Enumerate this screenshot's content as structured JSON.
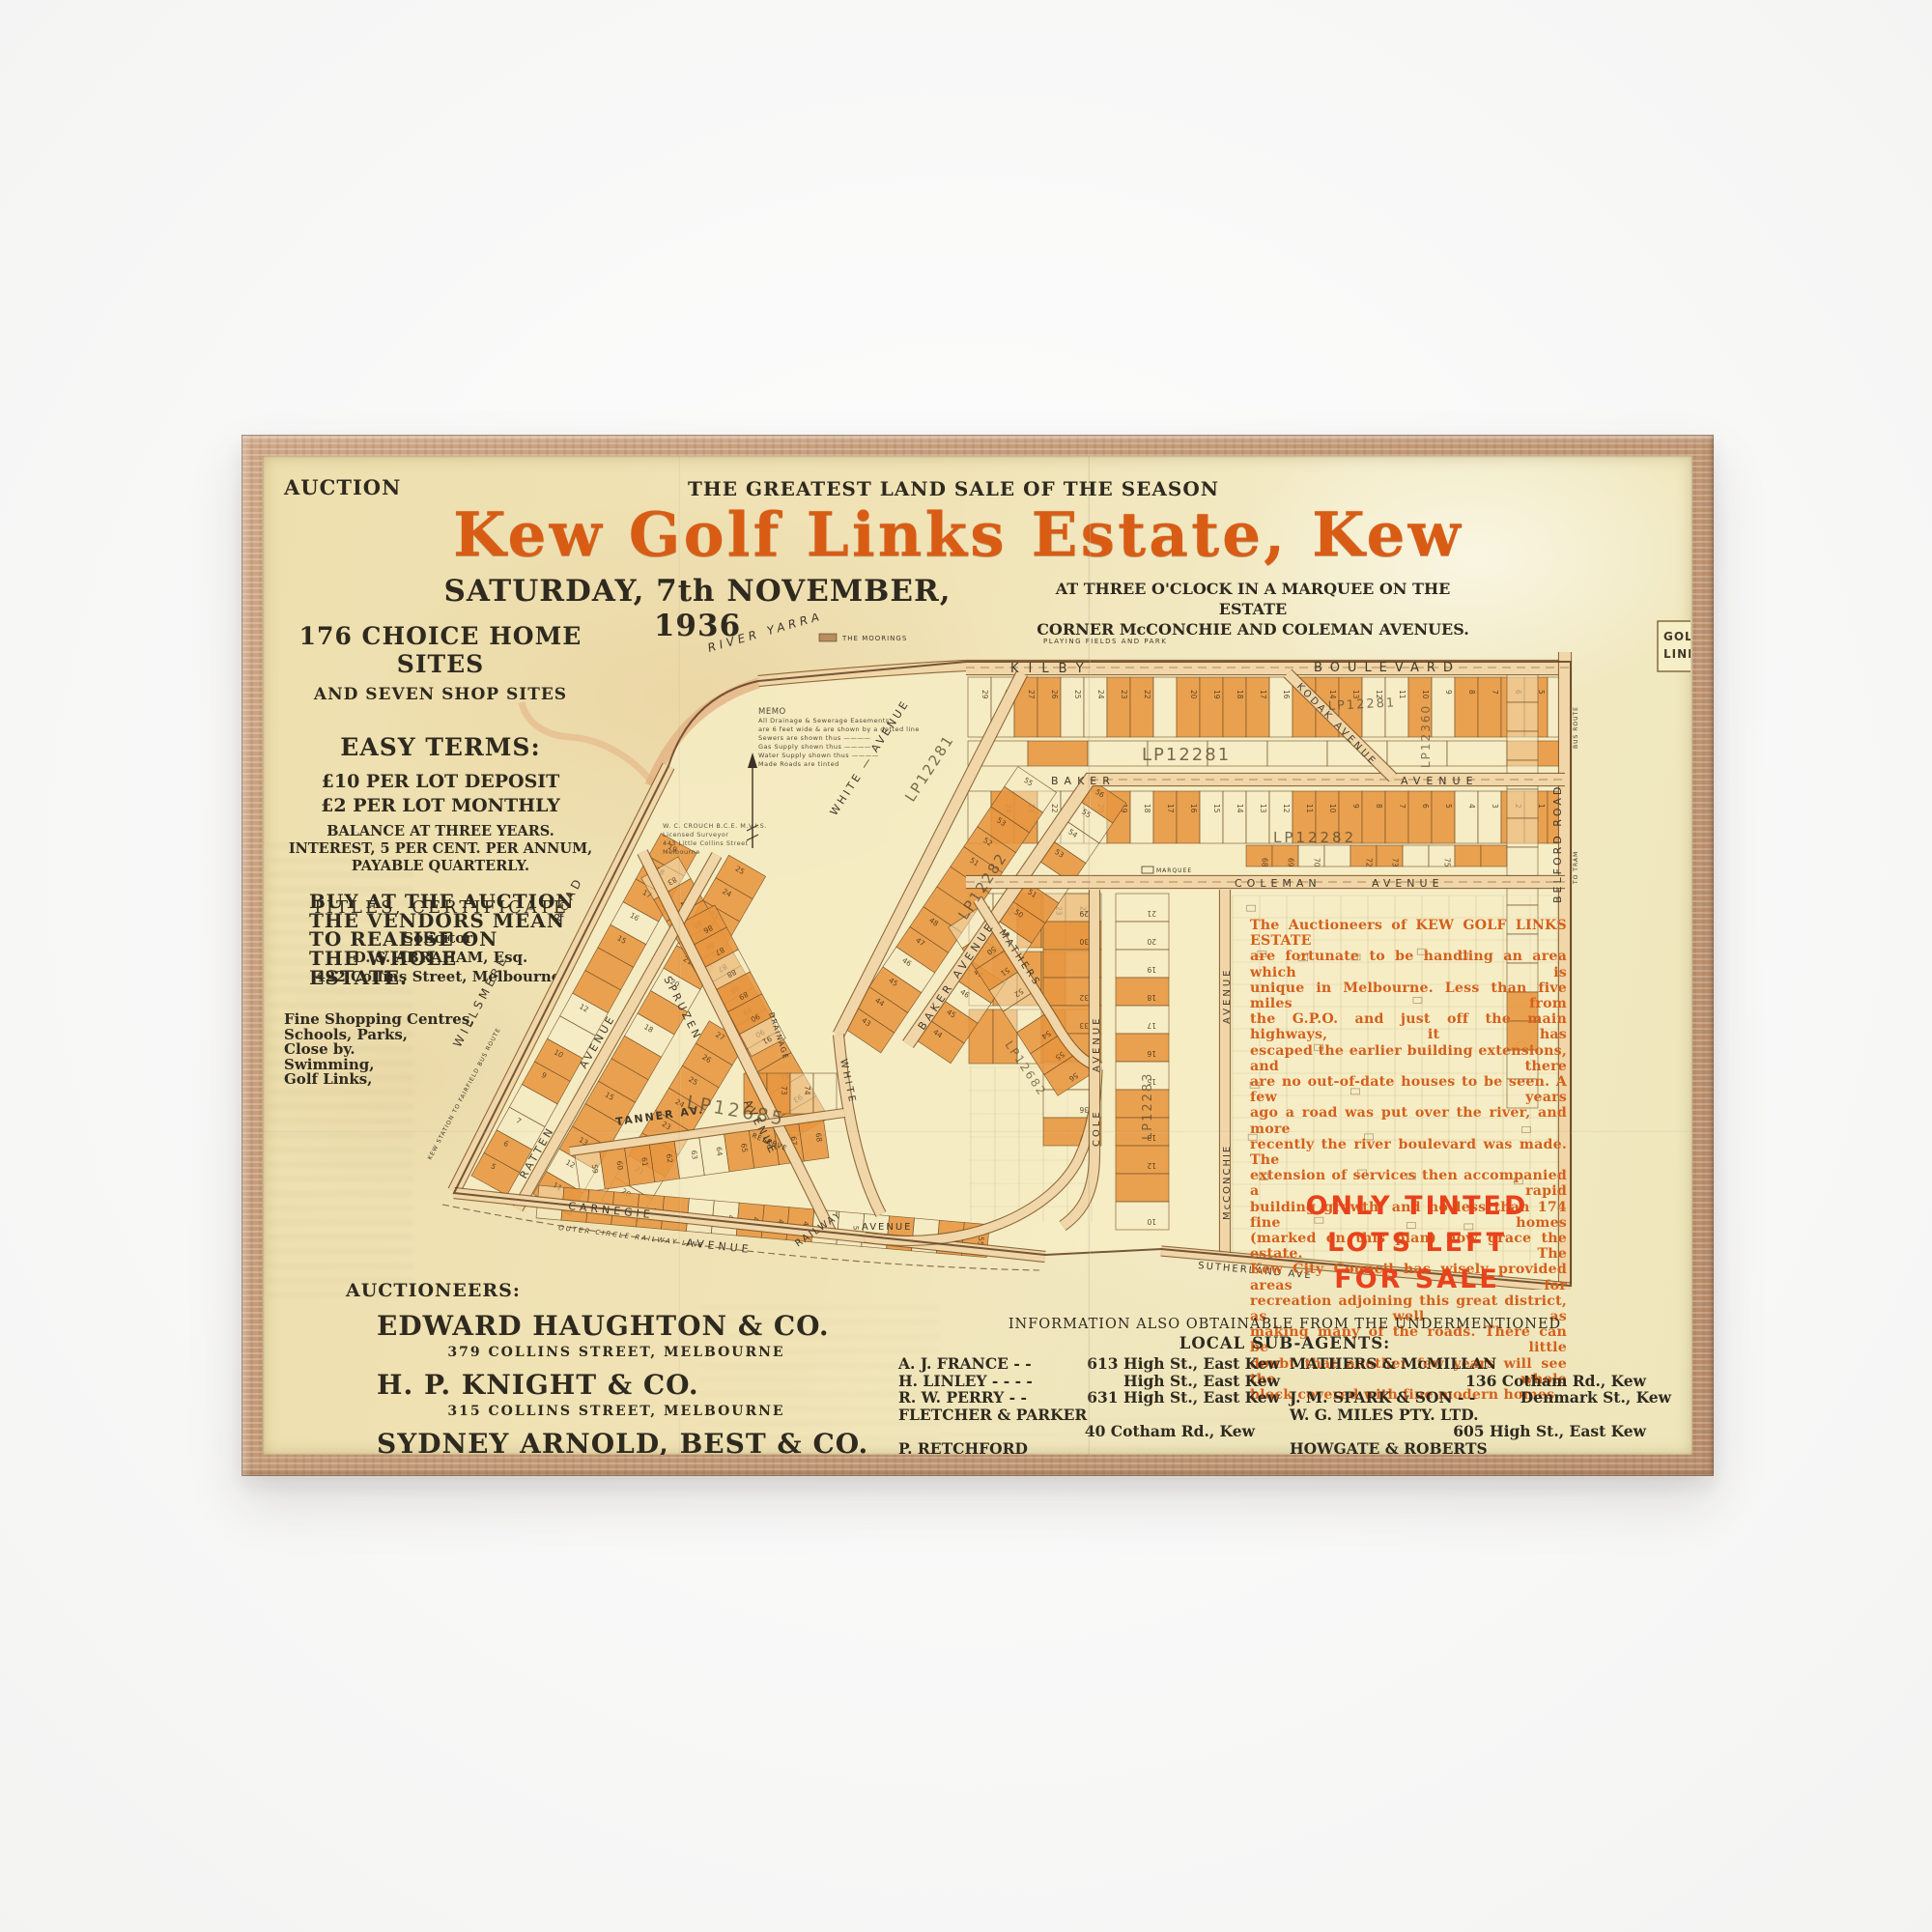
{
  "artwork": {
    "header": {
      "auction_label": "AUCTION",
      "tagline": "THE GREATEST LAND SALE OF THE SEASON",
      "title": "Kew Golf Links Estate, Kew",
      "date_line": "SATURDAY, 7th NOVEMBER, 1936",
      "venue_line1": "AT THREE O'CLOCK IN A MARQUEE ON THE ESTATE",
      "venue_line2": "CORNER McCONCHIE AND COLEMAN AVENUES."
    },
    "left_column": {
      "sites_heading": "176 CHOICE HOME SITES",
      "sites_subheading": "AND SEVEN SHOP SITES",
      "terms_heading": "EASY TERMS:",
      "terms_line1": "£10 PER LOT DEPOSIT",
      "terms_line2": "£2 PER LOT MONTHLY",
      "terms_line3": "BALANCE AT THREE YEARS.",
      "terms_line4": "INTEREST, 5 PER CENT. PER ANNUM,",
      "terms_line5": "PAYABLE QUARTERLY.",
      "titles_line": "TITLES, CERTIFICATE",
      "solicitor_label": "Solicitor:",
      "solicitor_name": "D. S. ABRAHAM, Esq.",
      "solicitor_address": "422 Collins Street, Melbourne.",
      "buy_lines": [
        "BUY AT THE AUCTION",
        "THE VENDORS MEAN",
        "TO REALISE ON",
        "THE WHOLE",
        "ESTATE."
      ],
      "amenities_lines": [
        "Fine Shopping Centres,",
        "Schools, Parks,",
        "Close by.",
        "Swimming,",
        "Golf Links,"
      ]
    },
    "auctioneers": {
      "heading": "AUCTIONEERS:",
      "firms": [
        {
          "name": "EDWARD HAUGHTON & CO.",
          "address": "379 COLLINS STREET, MELBOURNE"
        },
        {
          "name": "H. P. KNIGHT & CO.",
          "address": "315 COLLINS STREET, MELBOURNE"
        },
        {
          "name": "SYDNEY ARNOLD, BEST & CO.",
          "address": "16 QUEEN STREET, MELBOURNE"
        }
      ]
    },
    "agents": {
      "info_line": "INFORMATION ALSO OBTAINABLE FROM THE UNDERMENTIONED",
      "heading": "LOCAL SUB-AGENTS:",
      "left": [
        {
          "name": "A. J. FRANCE  -   -",
          "address": "613 High St., East Kew",
          "inline": true
        },
        {
          "name": "H. LINLEY  -   -   -   -",
          "address": "High St., East Kew",
          "inline": true
        },
        {
          "name": "R. W. PERRY  -   -",
          "address": "631 High St., East Kew",
          "inline": true
        },
        {
          "name": "FLETCHER & PARKER",
          "address": "40 Cotham Rd., Kew",
          "inline": false
        },
        {
          "name": "P. RETCHFORD",
          "address": "Cor. High and Denmark Sts., Kew",
          "inline": false
        }
      ],
      "right": [
        {
          "name": "MATHERS & McMILLAN",
          "address": "136 Cotham Rd., Kew",
          "inline": false
        },
        {
          "name": "J. M. SPARK & SON -   -",
          "address": "Denmark St., Kew",
          "inline": true
        },
        {
          "name": "W. G. MILES PTY. LTD.",
          "address": "605 High St., East Kew",
          "inline": false
        },
        {
          "name": "HOWGATE & ROBERTS",
          "address": "182 Victoria St., Richmond",
          "inline": false
        }
      ]
    },
    "map": {
      "streets": {
        "kilby": "KILBY",
        "kilby2": "BOULEVARD",
        "kodak": "KODAK AVENUE",
        "baker": "BAKER",
        "avenue": "AVENUE",
        "coleman": "COLEMAN",
        "white": "WHITE — AVENUE",
        "white2": "WHITE",
        "willsmere": "WILLSMERE",
        "road": "ROAD",
        "ratten": "RATTEN",
        "spruzen": "SPRUZEN",
        "tanner": "TANNER AV.",
        "carnegie": "CARNEGIE",
        "railway": "RAILWAY",
        "sutherland": "SUTHERLAND AVE",
        "mathers": "MATHERS",
        "cole": "COLE",
        "mcconchie": "McCONCHIE",
        "belford": "BELFORD  ROAD"
      },
      "plan_numbers": [
        "LP12281",
        "LP12282",
        "LP12283",
        "LP12360",
        "LP12685",
        "LP12682"
      ],
      "area_labels": {
        "river": "RIVER YARRA",
        "moorings": "THE MOORINGS",
        "playing": "PLAYING  FIELDS  AND  PARK",
        "marquee": "MARQUEE",
        "reserve": "RESERVE",
        "drainage": "DRAINAGE",
        "outer_rail": "OUTER  CIRCLE  RAILWAY  LINE",
        "bus_route": "KEW STATION TO FAIRFIELD BUS ROUTE",
        "to_tram": "TO TRAM",
        "bus2": "BUS ROUTE",
        "golf1": "GOLF",
        "golf2": "LINKS"
      },
      "memo_lines": [
        "MEMO",
        "All Drainage & Sewerage Easements",
        "are 6 feet wide & are shown by a dotted line",
        "Sewers are shown thus ————",
        "Gas Supply shown thus ————",
        "Water Supply shown thus ————",
        "Made Roads are tinted"
      ],
      "surveyor_lines": [
        "W. C. CROUCH  B.C.E.  M.V.I.S.",
        "Licensed Surveyor",
        "443 Little Collins Street",
        "Melbourne"
      ],
      "note_lines": [
        "The Auctioneers of KEW GOLF LINKS ESTATE",
        "are fortunate to be handling an area which is",
        "unique in Melbourne.  Less than five miles from",
        "the G.P.O. and just off the main highways, it has",
        "escaped the earlier building extensions, and there",
        "are no out-of-date houses to be seen.  A few years",
        "ago a road was put over the river, and more",
        "recently the river boulevard was made.  The",
        "extension of services then accompanied a rapid",
        "building growth, and no less than 174 fine homes",
        "(marked on this plan) now grace the estate.  The",
        "Kew City Council has wisely provided areas for",
        "recreation adjoining this great district, as well as",
        "making many of the roads.  There can be little",
        "doubt that another few years will see the whole",
        "block covered with fine modern homes."
      ],
      "sale_note_line1": "ONLY TINTED LOTS LEFT",
      "sale_note_line2": "FOR SALE"
    },
    "colors": {
      "title_orange": "#d95c15",
      "note_orange": "#d4601c",
      "sale_red": "#e8421c",
      "lot_tint": "#e79640",
      "paper": "#f0e3b6",
      "ink": "#2f2a1f"
    }
  }
}
